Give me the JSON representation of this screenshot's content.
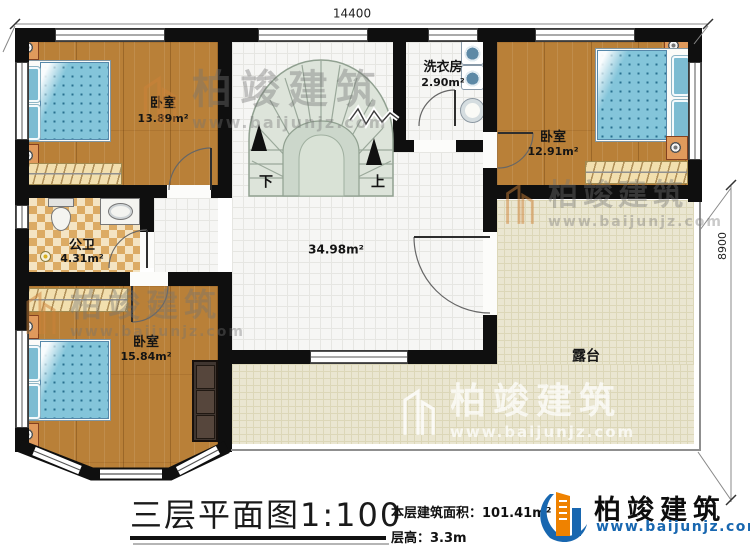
{
  "dimensions": {
    "top": "14400",
    "right": "8900"
  },
  "rooms": {
    "bedroom_top_left": {
      "name": "卧室",
      "area": "13.89m²"
    },
    "laundry": {
      "name": "洗衣房",
      "area": "2.90m²"
    },
    "bedroom_top_right": {
      "name": "卧室",
      "area": "12.91m²"
    },
    "bathroom": {
      "name": "公卫",
      "area": "4.31m²"
    },
    "hall": {
      "area": "34.98m²"
    },
    "bedroom_bottom_left": {
      "name": "卧室",
      "area": "15.84m²"
    },
    "terrace": {
      "name": "露台"
    }
  },
  "stairs": {
    "down_label": "下",
    "up_label": "上"
  },
  "watermark": {
    "brand": "柏竣建筑",
    "url": "www.baijunjz.com"
  },
  "title_block": {
    "title": "三层平面图",
    "scale": "1:100",
    "area_label": "本层建筑面积：",
    "area_value": "101.41m²",
    "floor_height_label": "层高：",
    "floor_height_value": "3.3m"
  },
  "logo": {
    "brand": "柏竣建筑",
    "url": "www.baijunjz.com"
  },
  "colors": {
    "wall": "#0f0f0f",
    "wood_floor": "#b98038",
    "hall_tile": "#f6f6f4",
    "terrace_tile": "#eae6d1",
    "bathroom_checker": "#dcab64",
    "stair_tread": "#dde4da",
    "bed": "#84c5da",
    "logo_orange": "#ef8200",
    "logo_blue": "#1867b0"
  }
}
